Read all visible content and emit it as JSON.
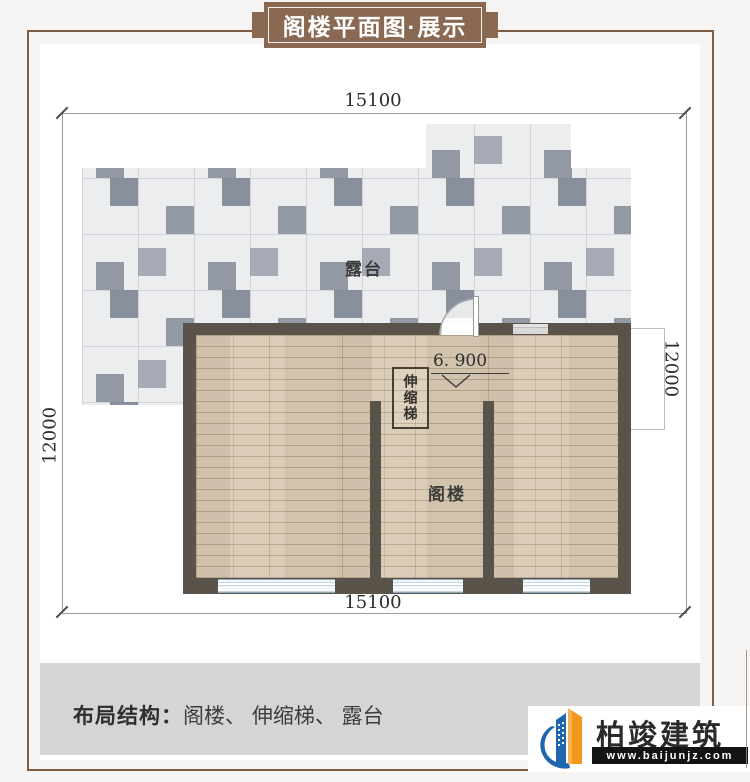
{
  "banner": {
    "title": "阁楼平面图·展示"
  },
  "dimensions": {
    "top": "15100",
    "bottom": "15100",
    "left": "12000",
    "right": "12000"
  },
  "plan": {
    "terrace_label": "露台",
    "attic_label": "阁楼",
    "stair_label": "伸缩梯",
    "level_value": "6. 900"
  },
  "footer": {
    "label": "布局结构：",
    "items": "阁楼、 伸缩梯、 露台"
  },
  "logo": {
    "name": "柏竣建筑",
    "url": "www.baijunjz.com"
  },
  "colors": {
    "banner_brown": "#8a6952",
    "frame_brown": "#7d5c43",
    "wall_dark": "#59534a",
    "floor_wood": "#d9c9b3",
    "tile_light": "#ecedef",
    "tile_dark": "#99a1ad",
    "window_blue": "#c2d8e4",
    "footer_gray": "#d5d5d5",
    "logo_blue": "#1f66ae",
    "logo_orange": "#f2991c"
  }
}
